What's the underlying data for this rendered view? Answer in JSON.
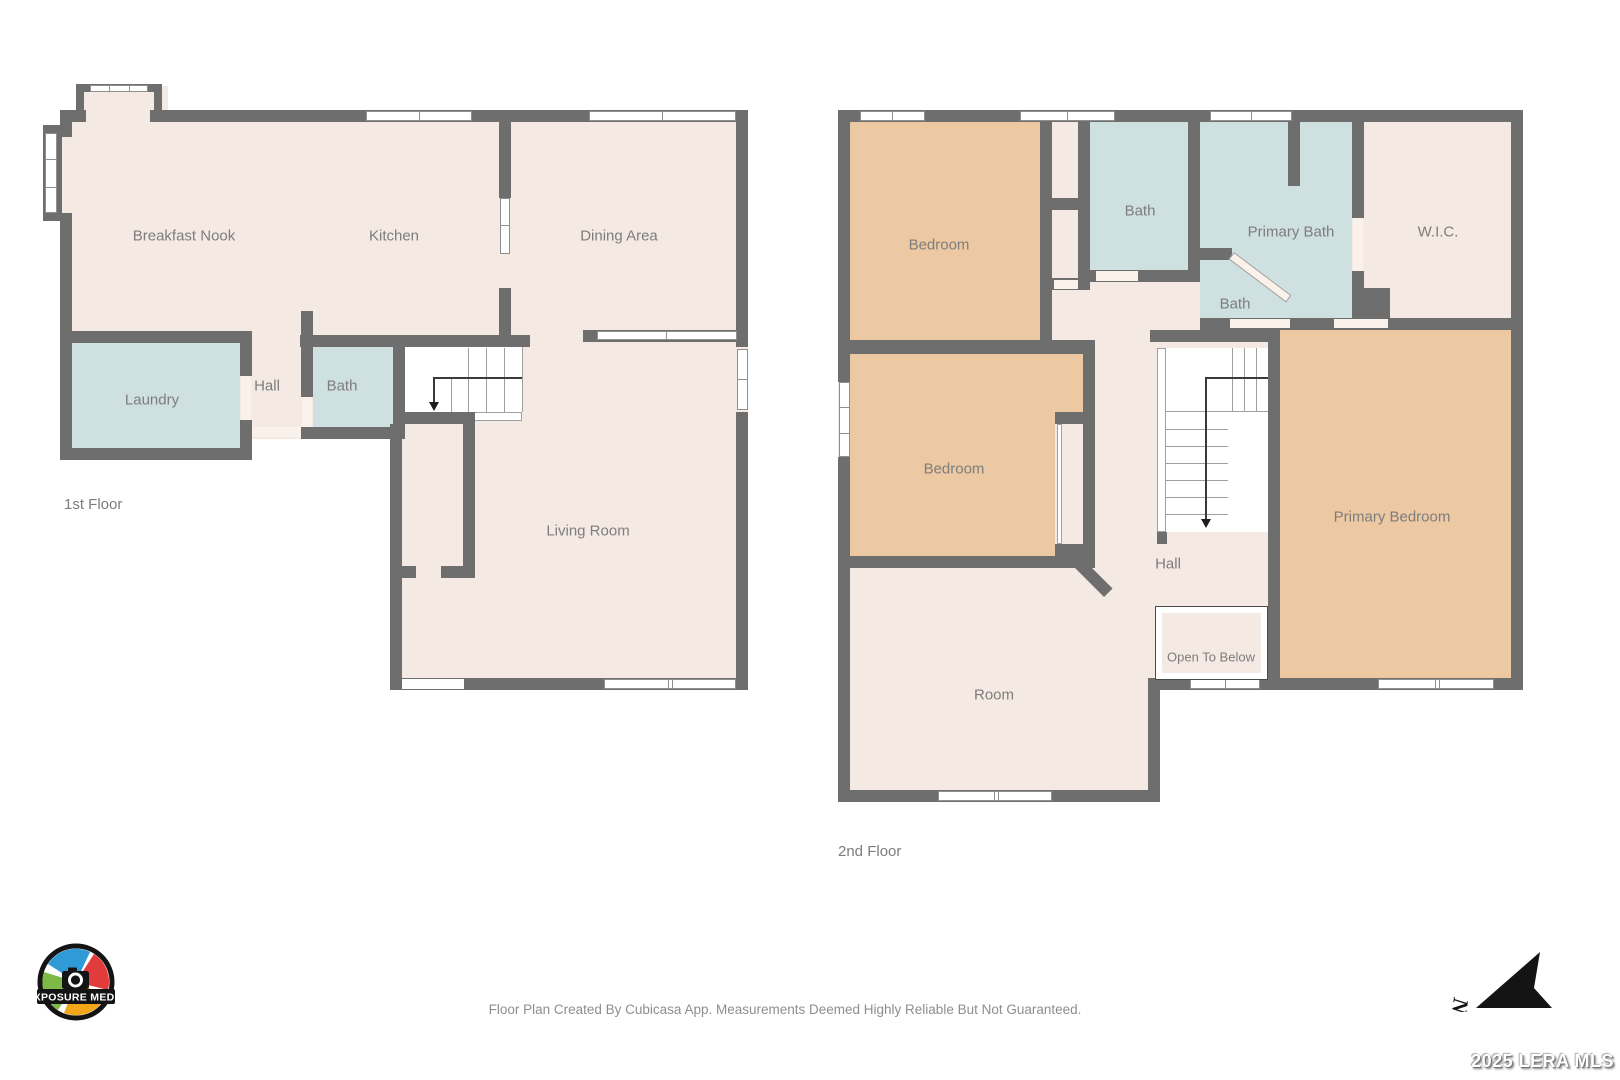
{
  "floor1": {
    "title": "1st Floor",
    "rooms": {
      "breakfast_nook": "Breakfast Nook",
      "kitchen": "Kitchen",
      "dining_area": "Dining Area",
      "laundry": "Laundry",
      "hall": "Hall",
      "bath": "Bath",
      "living_room": "Living Room"
    }
  },
  "floor2": {
    "title": "2nd Floor",
    "rooms": {
      "bedroom_top": "Bedroom",
      "bath_top": "Bath",
      "primary_bath": "Primary Bath",
      "wic": "W.I.C.",
      "bath_small": "Bath",
      "bedroom_mid": "Bedroom",
      "primary_bedroom": "Primary Bedroom",
      "hall": "Hall",
      "open_to_below": "Open To Below",
      "room": "Room"
    }
  },
  "footer": {
    "disclaimer": "Floor Plan Created By Cubicasa App. Measurements Deemed Highly Reliable But Not Guaranteed."
  },
  "watermark": {
    "text": "2025 LERA MLS"
  },
  "logo": {
    "text": "EXPOSURE MEDIA"
  },
  "compass": {
    "north_label": "N"
  },
  "colors": {
    "wall": "#6e6e6e",
    "floor_cream": "#f5eae3",
    "bedroom_orange": "#ecc9a3",
    "bath_blue": "#cfe0e1",
    "label_gray": "#7d7d7d",
    "threshold": "#f9f1ea"
  }
}
